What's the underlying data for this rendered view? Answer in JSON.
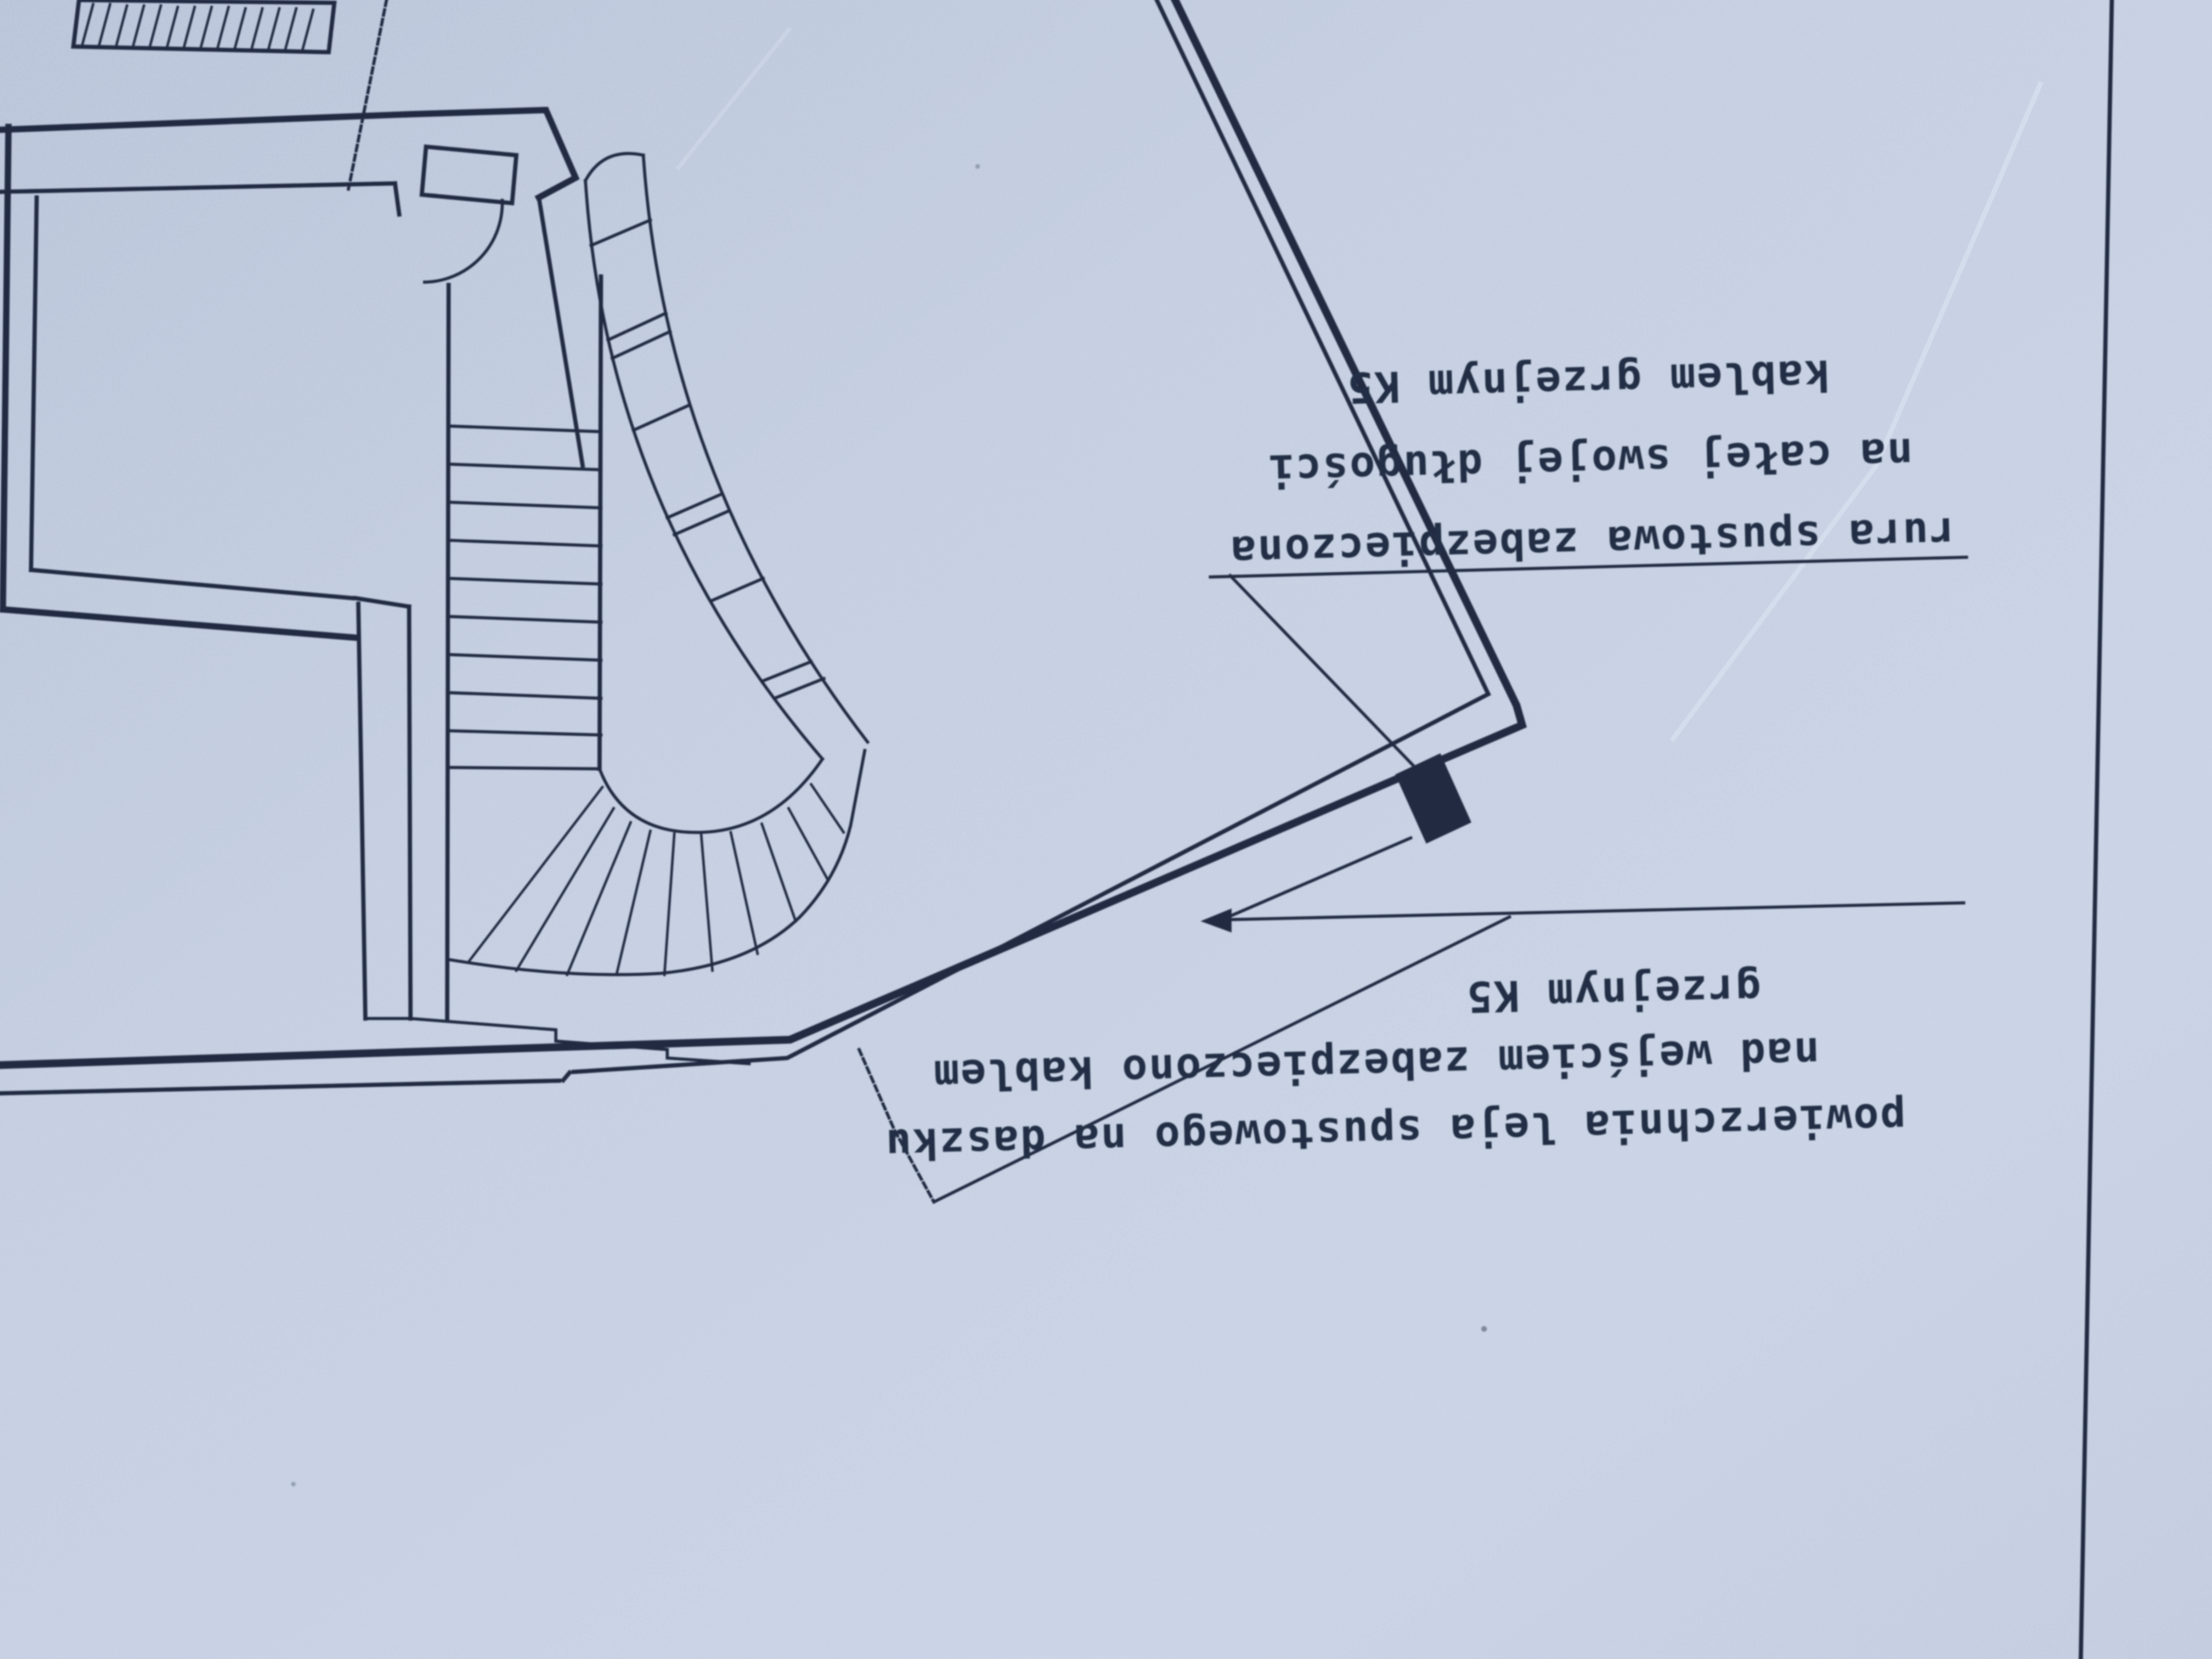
{
  "sheet": {
    "annotations": {
      "downpipe_note": {
        "lines": [
          "rura spustowa zabezpieczona",
          "na całej swojej długości",
          "kablem grzejnym K5"
        ]
      },
      "funnel_note": {
        "lines": [
          "powierzchnia leja spustowego na daszku",
          "nad wejściem zabezpieczono kablem",
          "grzejnym K5"
        ]
      }
    },
    "colors": {
      "paper": "#c3cde0",
      "ink": "#222c42"
    }
  }
}
